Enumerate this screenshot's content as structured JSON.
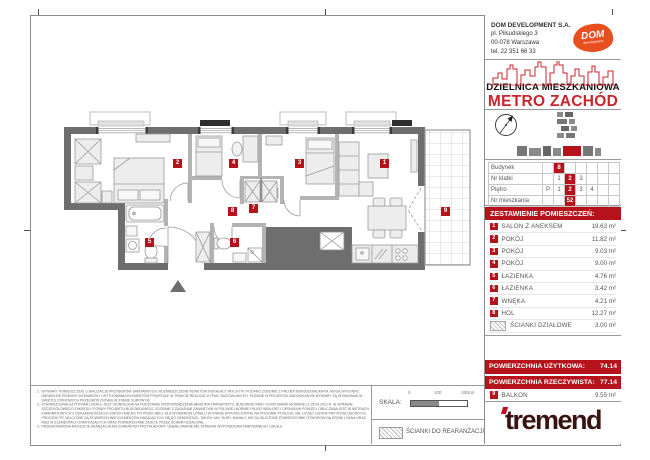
{
  "company": {
    "name": "DOM DEVELOPMENT S.A.",
    "address_line1": "pl. Piłsudskiego 3",
    "address_line2": "00-078 Warszawa",
    "phone": "tel. 22 351 66 33",
    "logo_text": "DOM",
    "logo_subtext": "development"
  },
  "project": {
    "district": "DZIELNICA MIESZKANIOWA",
    "name": "METRO ZACHÓD"
  },
  "unit_table": {
    "rows": [
      {
        "label": "Budynek",
        "cells": [
          "",
          "8",
          "",
          "",
          "",
          "",
          ""
        ]
      },
      {
        "label": "Nr klatki",
        "cells": [
          "",
          "1",
          "2",
          "3",
          "",
          "",
          ""
        ]
      },
      {
        "label": "Piętro",
        "cells": [
          "P",
          "1",
          "2",
          "3",
          "4",
          "",
          ""
        ]
      },
      {
        "label": "Nr mieszkania",
        "cells": [
          "",
          "",
          "52",
          "",
          "",
          "",
          ""
        ]
      }
    ]
  },
  "rooms": {
    "header": "ZESTAWIENIE POMIESZCZEŃ:",
    "items": [
      {
        "num": "1",
        "label": "SALON Z ANEKSEM",
        "area": "19.63 m²"
      },
      {
        "num": "2",
        "label": "POKÓJ",
        "area": "11.82 m²"
      },
      {
        "num": "3",
        "label": "POKÓJ",
        "area": "9.03 m²"
      },
      {
        "num": "4",
        "label": "POKÓJ",
        "area": "9.00 m²"
      },
      {
        "num": "5",
        "label": "ŁAZIENKA",
        "area": "4.76 m²"
      },
      {
        "num": "6",
        "label": "ŁAZIENKA",
        "area": "3.42 m²"
      },
      {
        "num": "7",
        "label": "WNĘKA",
        "area": "4.21 m²"
      },
      {
        "num": "8",
        "label": "HOL",
        "area": "12.27 m²"
      }
    ],
    "partitions": {
      "label": "ŚCIANKI DZIAŁOWE",
      "area": "3.00 m²"
    }
  },
  "summary": {
    "usable_label": "POWIERZCHNIA UŻYTKOWA:",
    "usable_value": "74.14",
    "actual_label": "POWIERZCHNIA RZECZYWISTA:",
    "actual_value": "77.14",
    "balcony": {
      "num": "9",
      "label": "BALKON",
      "area": "9.55 m²"
    }
  },
  "plan": {
    "markers": [
      "1",
      "2",
      "3",
      "4",
      "5",
      "6",
      "7",
      "8",
      "9"
    ]
  },
  "scale": {
    "label": "SKALA:",
    "tick0": "0",
    "tick1": "100",
    "tick2": "200cm"
  },
  "legend": {
    "rearrangement_label": "ŚCIANKI DO REARANŻACJI"
  },
  "brand": {
    "name": "tremend"
  },
  "colors": {
    "accent_red": "#b5121b",
    "metro_red": "#c9252c",
    "dom_orange": "#e84e1e",
    "wall_dark": "#6e6e6e",
    "wall_light": "#b3b3b3",
    "tremend_brown": "#371410"
  },
  "disclaimer": {
    "items": [
      {
        "n": "1.",
        "text": "WYMIARY POMIESZCZEŃ, LOKALIZACJE PRZYBORÓW SANITARNYCH, ROZMIESZCZENIE PUNKTÓW INSTALACYJNYCH ITP. PODANO ZGODNIE Z PROJEKTEM BUDOWLANYM. MOGĄ WYSTĄPIĆ NIEWIELKIE RÓŻNICE WYMIARÓW I USYTUOWANIA ELEMENTÓW POWSTAŁE W TRAKCIE REALIZACJI PRAC BUDOWLANYCH. PODANE W PROJEKCIE BUDOWLANYM WYMIARY SĄ WYMIARAMI W ŚWIETLE PIONOWYCH PRZEGRÓD (ŚCIAN) W STANIE SUROWYM."
      },
      {
        "n": "2.",
        "text": "POWIERZCHNIA UŻYTKOWA LOKALU JEST OKREŚLONA NA PODSTAWIE ROZPORZĄDZENIA MINISTRA TRANSPORTU, BUDOWNICTWA I GOSPODARKI MORSKIEJ Z 25.04.2012 R. W SPRAWIE SZCZEGÓŁOWEGO ZAKRESU I FORMY PROJEKTU BUDOWLANEGO, ZGODNIE Z ZASADAMI ZAWARTYMI W POLSKIEJ NORMIE PN-ISO 9836:1997 I OPISANYMI PONIŻEJ. OBLICZANA JEST W METRACH KWADRATOWYCH Z DOKŁADNOŚCIĄ DO DWÓCH MIEJSC PO PRZECINKU, DLA WYMIARÓW LOKALU W STANIE WYKOŃCZONYM, NA POZIOMIE PODŁOGI, NIE LICZĄC LISTEW PRZYPODŁOGOWYCH, PROGÓW ITP. WLICZONE SĄ POWIERZCHNIE ELEMENTÓW NADAJĄCYCH SIĘ DO DEMONTAŻU, TAKICH JAK: RURY, KANAŁY. NIE SĄ WLICZONE POWIERZCHNIE OTWORÓW NA DRZWI I OKNA ORAZ NISZ W ELEMENTACH ZAMYKAJĄCYCH ORAZ POWIERZCHNIE ZAJĘTE PRZEZ ŚCIANKI DZIAŁOWE."
      },
      {
        "n": "3.",
        "text": "PRZEDSTAWIONA NA RZUCIE ARANŻACJA MA CHARAKTER PRZYKŁADOWY. UMEBLOWANIE NIE STANOWI WYPOSAŻENIA NABYWANEGO LOKALU."
      }
    ]
  }
}
